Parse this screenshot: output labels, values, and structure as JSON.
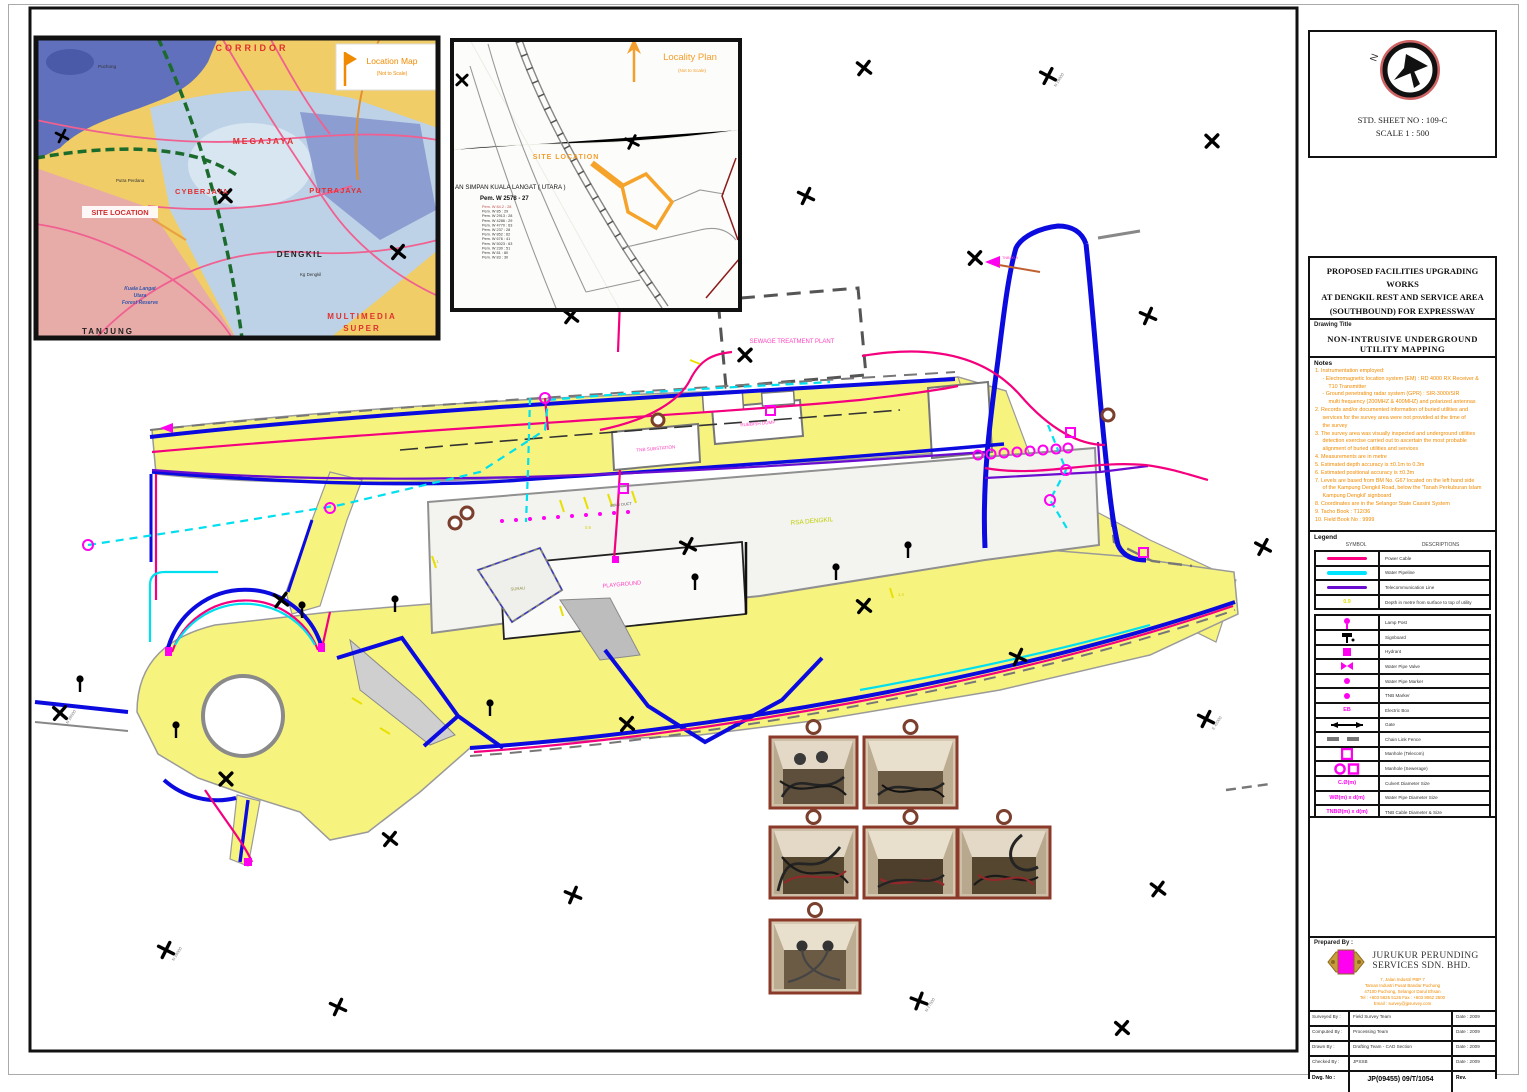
{
  "sheet": {
    "north_letter": "N",
    "std_sheet_no": "STD. SHEET NO : 109-C",
    "scale": "SCALE 1 : 500"
  },
  "title_block": {
    "project_title": [
      "PROPOSED FACILITIES UPGRADING WORKS",
      "AT DENGKIL REST AND SERVICE AREA",
      "(SOUTHBOUND) FOR EXPRESSWAY",
      "LINGKARAN TENGAH SDN BHD"
    ],
    "drawing_title_label": "Drawing Title",
    "drawing_title": "NON-INTRUSIVE UNDERGROUND UTILITY MAPPING"
  },
  "notes": {
    "header": "Notes",
    "lines": [
      "1. Instrumentation employed:",
      "     - Electromagnetic location system (EM) : RD 4000 RX Receiver &",
      "         T10 Transmitter",
      "     - Ground penetrating radar system (GPR) : SIR-3000/SIR",
      "         multi frequency (200MHZ & 400MHZ) and polarized antennas",
      "2. Records and/or documented information of buried utilities and",
      "     services for the survey area were not provided at the time of",
      "     the survey",
      "3. The survey area was visually inspected and underground utilities",
      "     detection exercise carried out to ascertain the most probable",
      "     alignment of buried utilities and services",
      "4. Measurements are in metre",
      "5. Estimated depth accuracy is ±0.1m to 0.3m",
      "6. Estimated positional accuracy is ±0.3m",
      "7. Levels are based from BM No. G67 located on the left hand side",
      "     of the Kampung Dengkil Road, below the 'Tanah Perkuburan Islam",
      "     Kampung Dengkil' signboard",
      "8. Coordinates are in the Selangor State Cassini System",
      "9. Tacho Book : T12/36",
      "10. Field Book No : 9999"
    ]
  },
  "legend": {
    "header": "Legend",
    "col_symbol": "SYMBOL",
    "col_desc": "DESCRIPTIONS",
    "items": [
      {
        "kind": "line",
        "color": "#FF0080",
        "desc": "Power Cable"
      },
      {
        "kind": "line",
        "color": "#00E5FF",
        "desc": "Water Pipeline"
      },
      {
        "kind": "line",
        "color": "#6A0DD0",
        "desc": "Telecommunication Line"
      },
      {
        "kind": "text",
        "sample": "0.9",
        "color": "#E8E000",
        "desc": "Depth in metre from surface to top of utility"
      },
      {
        "kind": "lamp",
        "color": "#FF00F0",
        "desc": "Lamp Post"
      },
      {
        "kind": "signboard",
        "color": "#000000",
        "desc": "Signboard"
      },
      {
        "kind": "hydrant",
        "color": "#FF00F0",
        "desc": "Hydrant"
      },
      {
        "kind": "valve",
        "color": "#FF00F0",
        "desc": "Water Pipe Valve"
      },
      {
        "kind": "dot",
        "color": "#FF00F0",
        "desc": "Water Pipe Marker"
      },
      {
        "kind": "dot",
        "color": "#FF00F0",
        "desc": "TNB Marker"
      },
      {
        "kind": "text",
        "sample": "EB",
        "color": "#FF00F0",
        "desc": "Electric Box"
      },
      {
        "kind": "gate",
        "color": "#000000",
        "desc": "Gate"
      },
      {
        "kind": "fence",
        "color": "#777777",
        "desc": "Chain Link Fence"
      },
      {
        "kind": "mh-t",
        "color": "#FF00F0",
        "desc": "Manhole (Telecom)"
      },
      {
        "kind": "mh-s",
        "color": "#FF00F0",
        "desc": "Manhole (Sewerage)"
      },
      {
        "kind": "text",
        "sample": "C.Ø(m)",
        "color": "#FF00F0",
        "desc": "Culvert Diameter Size"
      },
      {
        "kind": "text",
        "sample": "WØ(m) x d(m)",
        "color": "#FF00F0",
        "desc": "Water Pipe Diameter Size"
      },
      {
        "kind": "text",
        "sample": "TNBØ(m) x d(m)",
        "color": "#FF00F0",
        "desc": "TNB Cable Diameter & Size"
      },
      {
        "kind": "text",
        "sample": "IL (m)",
        "color": "#F08A00",
        "desc": "Invert Level"
      },
      {
        "kind": "text",
        "sample": "SL (m)",
        "color": "#F08A00",
        "desc": "Spot Level"
      }
    ]
  },
  "prepared_by": {
    "label": "Prepared By :",
    "company_line1": "JURUKUR PERUNDING",
    "company_line2": "SERVICES SDN. BHD.",
    "address_lines": [
      "7, Jalan Industri PBP 7",
      "Taman Industri Pusat Bandar Puchong",
      "47100 Puchong, Selangor Darul Ehsan",
      "Tel : +603 5825 5126   Fax : +603 8062 2500",
      "Email : survey@jpsurvey.com"
    ]
  },
  "approval_table": {
    "rows": [
      {
        "label": "Surveyed By :",
        "value": "Field Survey Team",
        "date": "Date : 2009"
      },
      {
        "label": "Computed By :",
        "value": "Processing Team",
        "date": "Date : 2009"
      },
      {
        "label": "Drawn By :",
        "value": "Drafting Team - CAD Section",
        "date": "Date : 2009"
      },
      {
        "label": "Checked By :",
        "value": "JPSSB",
        "date": "Date : 2009"
      }
    ],
    "dwg_no_label": "Dwg. No :",
    "dwg_no": "JP(09455) 09/T/1054",
    "rev_label": "Rev."
  },
  "location_map": {
    "title": "Location Map",
    "subtitle": "(Not to Scale)",
    "site_location": "SITE LOCATION",
    "corridor": "CORRIDOR",
    "megajaya": "MEGAJAYA",
    "cyberjaya": "CYBERJAYA",
    "putrajaya": "PUTRAJAYA",
    "dengkil": "DENGKIL",
    "multimedia": "MULTIMEDIA",
    "super": "SUPER",
    "tanjung": "TANJUNG",
    "forest1": "Kuala Langat",
    "forest2": "Utara",
    "forest3": "Forest Reserve",
    "town1": "Puchong",
    "town2": "Putra Perdana",
    "town3": "Kg Dengkil"
  },
  "locality_plan": {
    "title": "Locality Plan",
    "subtitle": "(Not to Scale)",
    "site_location": "SITE LOCATION",
    "road_name": "AN SIMPAN KUALA LANGAT ( UTARA )",
    "ref": "Pem. W 2578 - 27",
    "table_rows": [
      "Pem. W   84.2 : 28",
      "Pem. W   85 : 29",
      "Pem. W   2913 : 28",
      "Pem. W   4286 : 29",
      "Pem. W   4770 : 63",
      "Pem. W   237 : 28",
      "Pem. W   852 : 62",
      "Pem. W   676 : 41",
      "Pem. W   5023 : 63",
      "Pem. W   230 : 51",
      "Pem. W   81 : 80",
      "Pem. W   83 : 30"
    ]
  },
  "site_plan": {
    "labels": {
      "sewage": "SEWAGE TREATMENT PLANT",
      "tnb": "TNB SUBSTATION",
      "rubbish": "RUBBISH DUMP",
      "rsa": "RSA DENGKIL",
      "playground": "PLAYGROUND",
      "surau": "SURAU",
      "duct": "4/Ø40 DUCT",
      "depth1": "0.9",
      "depth2": "1.1",
      "depth3": "1.4",
      "tnb_cable": "TNBØ0.9"
    },
    "grid_labels": [
      "N 28500",
      "N 28000",
      "E 41500",
      "N 27500",
      "E 42000",
      "N 29000"
    ]
  },
  "colors": {
    "power": "#F4007E",
    "water": "#00DFEF",
    "telecom": "#6A0DD0",
    "road_fill": "#F7F37F",
    "kerb": "#0B0BE0",
    "marker": "#FF00F0",
    "depth": "#E8E000"
  }
}
